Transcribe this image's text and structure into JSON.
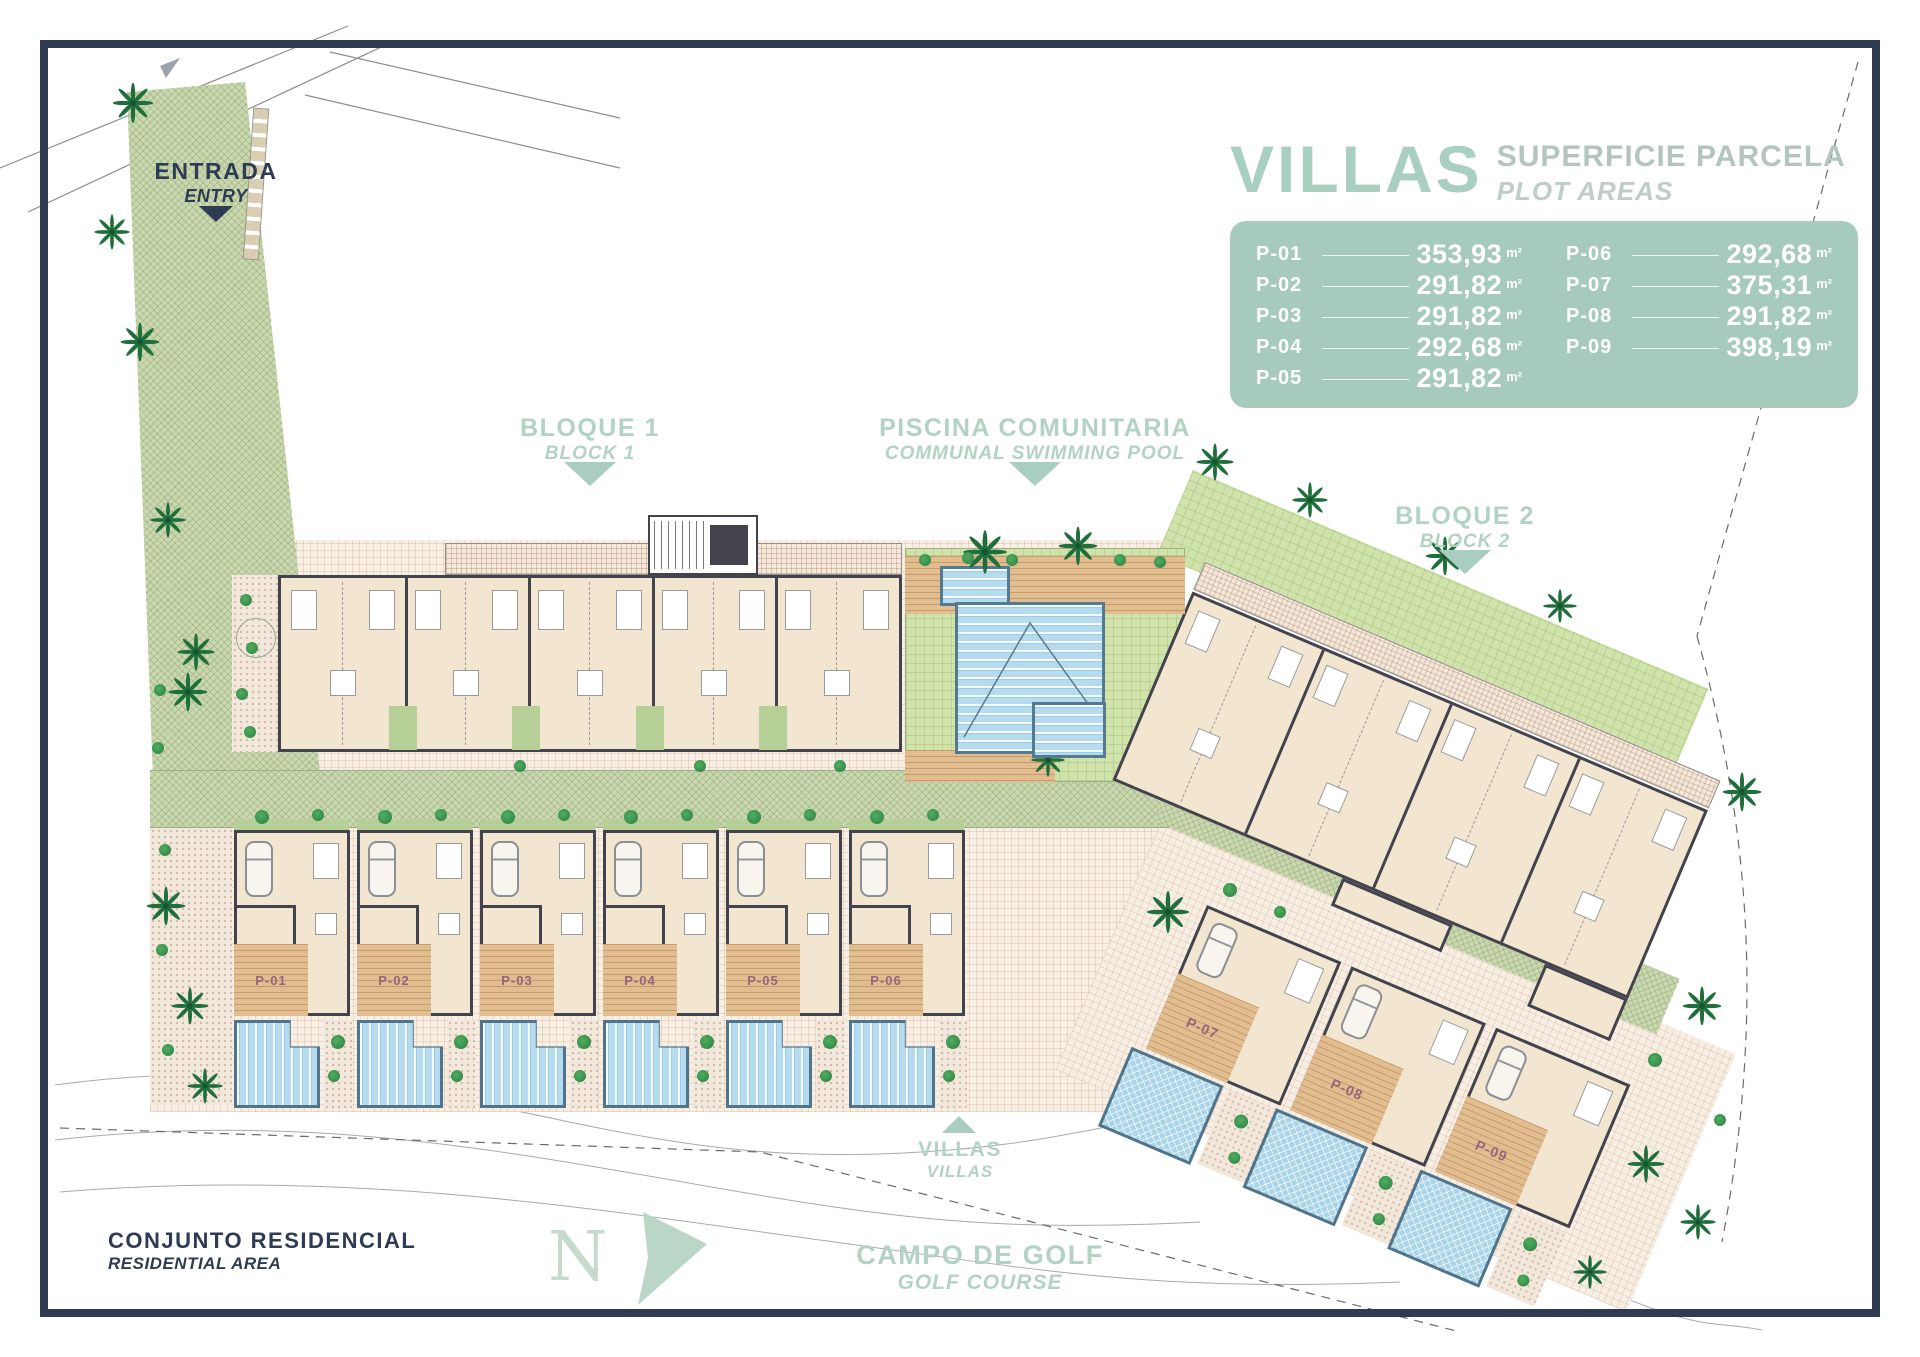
{
  "legend": {
    "title": "VILLAS",
    "subtitle_es": "SUPERFICIE PARCELA",
    "subtitle_en": "PLOT AREAS",
    "unit": "m²",
    "plots_col1": [
      {
        "id": "P-01",
        "area": "353,93"
      },
      {
        "id": "P-02",
        "area": "291,82"
      },
      {
        "id": "P-03",
        "area": "291,82"
      },
      {
        "id": "P-04",
        "area": "292,68"
      },
      {
        "id": "P-05",
        "area": "291,82"
      }
    ],
    "plots_col2": [
      {
        "id": "P-06",
        "area": "292,68"
      },
      {
        "id": "P-07",
        "area": "375,31"
      },
      {
        "id": "P-08",
        "area": "291,82"
      },
      {
        "id": "P-09",
        "area": "398,19"
      }
    ]
  },
  "annotations": {
    "entrance_es": "ENTRADA",
    "entrance_en": "ENTRY",
    "block1_es": "BLOQUE 1",
    "block1_en": "BLOCK 1",
    "pool_es": "PISCINA COMUNITARIA",
    "pool_en": "COMMUNAL SWIMMING POOL",
    "block2_es": "BLOQUE 2",
    "block2_en": "BLOCK 2",
    "villas_es": "VILLAS",
    "villas_en": "VILLAS",
    "residential_es": "CONJUNTO RESIDENCIAL",
    "residential_en": "RESIDENTIAL AREA",
    "golf_es": "CAMPO DE GOLF",
    "golf_en": "GOLF COURSE",
    "north": "N"
  },
  "plot_markers": {
    "row": [
      "P-01",
      "P-02",
      "P-03",
      "P-04",
      "P-05",
      "P-06"
    ],
    "cluster": [
      "P-07",
      "P-08",
      "P-09"
    ]
  },
  "colors": {
    "frame_navy": "#2e3b52",
    "label_green": "#b2d2c3",
    "legend_panel": "#a6cabb",
    "plot_label_purple": "#98647d",
    "pool_blue": "#b6dbee",
    "deck_tan": "#e2bd90",
    "lawn_green": "#cfe3ab"
  }
}
